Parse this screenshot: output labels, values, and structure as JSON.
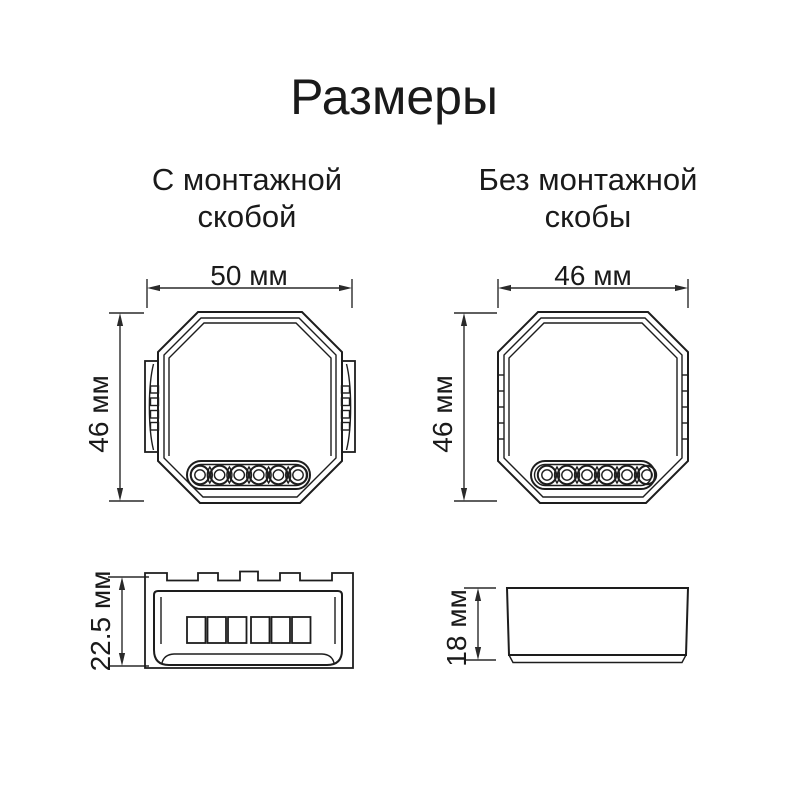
{
  "title": "Размеры",
  "views": {
    "front_with_bracket": {
      "heading_line1": "С монтажной",
      "heading_line2": "скобой",
      "width_label": "50 мм",
      "height_label": "46 мм"
    },
    "front_without_bracket": {
      "heading_line1": "Без монтажной",
      "heading_line2": "скобы",
      "width_label": "46 мм",
      "height_label": "46 мм"
    },
    "side_with_bracket": {
      "depth_label": "22.5 мм"
    },
    "side_without_bracket": {
      "depth_label": "18 мм"
    }
  },
  "colors": {
    "line": "#1d1d1d",
    "text": "#1a1a1a",
    "background": "#ffffff"
  }
}
